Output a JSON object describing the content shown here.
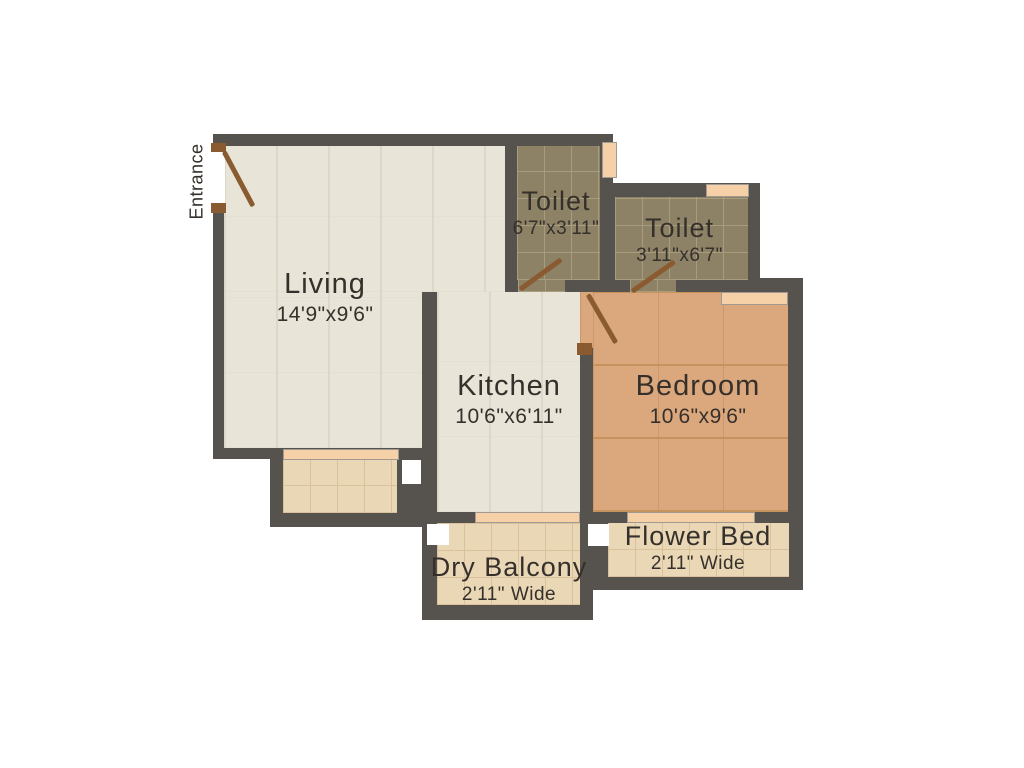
{
  "title": "1 BHK Floor Plan",
  "entrance_label": "Entrance",
  "rooms": [
    {
      "id": "living",
      "label": "Living",
      "dims": "14'9\"x9'6\""
    },
    {
      "id": "toilet_1",
      "label": "Toilet",
      "dims": "6'7\"x3'11\""
    },
    {
      "id": "toilet_2",
      "label": "Toilet",
      "dims": "3'11\"x6'7\""
    },
    {
      "id": "kitchen",
      "label": "Kitchen",
      "dims": "10'6\"x6'11\""
    },
    {
      "id": "bedroom",
      "label": "Bedroom",
      "dims": "10'6\"x9'6\""
    },
    {
      "id": "dry_balcony",
      "label": "Dry Balcony",
      "dims": "2'11\" Wide"
    },
    {
      "id": "flower_bed",
      "label": "Flower Bed",
      "dims": "2'11\" Wide"
    }
  ],
  "colors": {
    "background": "#ffffff",
    "wall": "#56524e",
    "floor_cream": "#e9e4d8",
    "floor_cream_line": "#ddd7ca",
    "floor_toilet": "#8d8266",
    "floor_toilet_line": "#a89c7e",
    "floor_wood": "#dba77d",
    "floor_wood_line": "#c6935f",
    "floor_tile": "#e9d7b6",
    "floor_tile_line": "#d8c19b",
    "window_fill": "#f6d0a6",
    "window_edge": "#a09a92",
    "door_wood": "#8a5a30",
    "label_text": "#35302b"
  }
}
